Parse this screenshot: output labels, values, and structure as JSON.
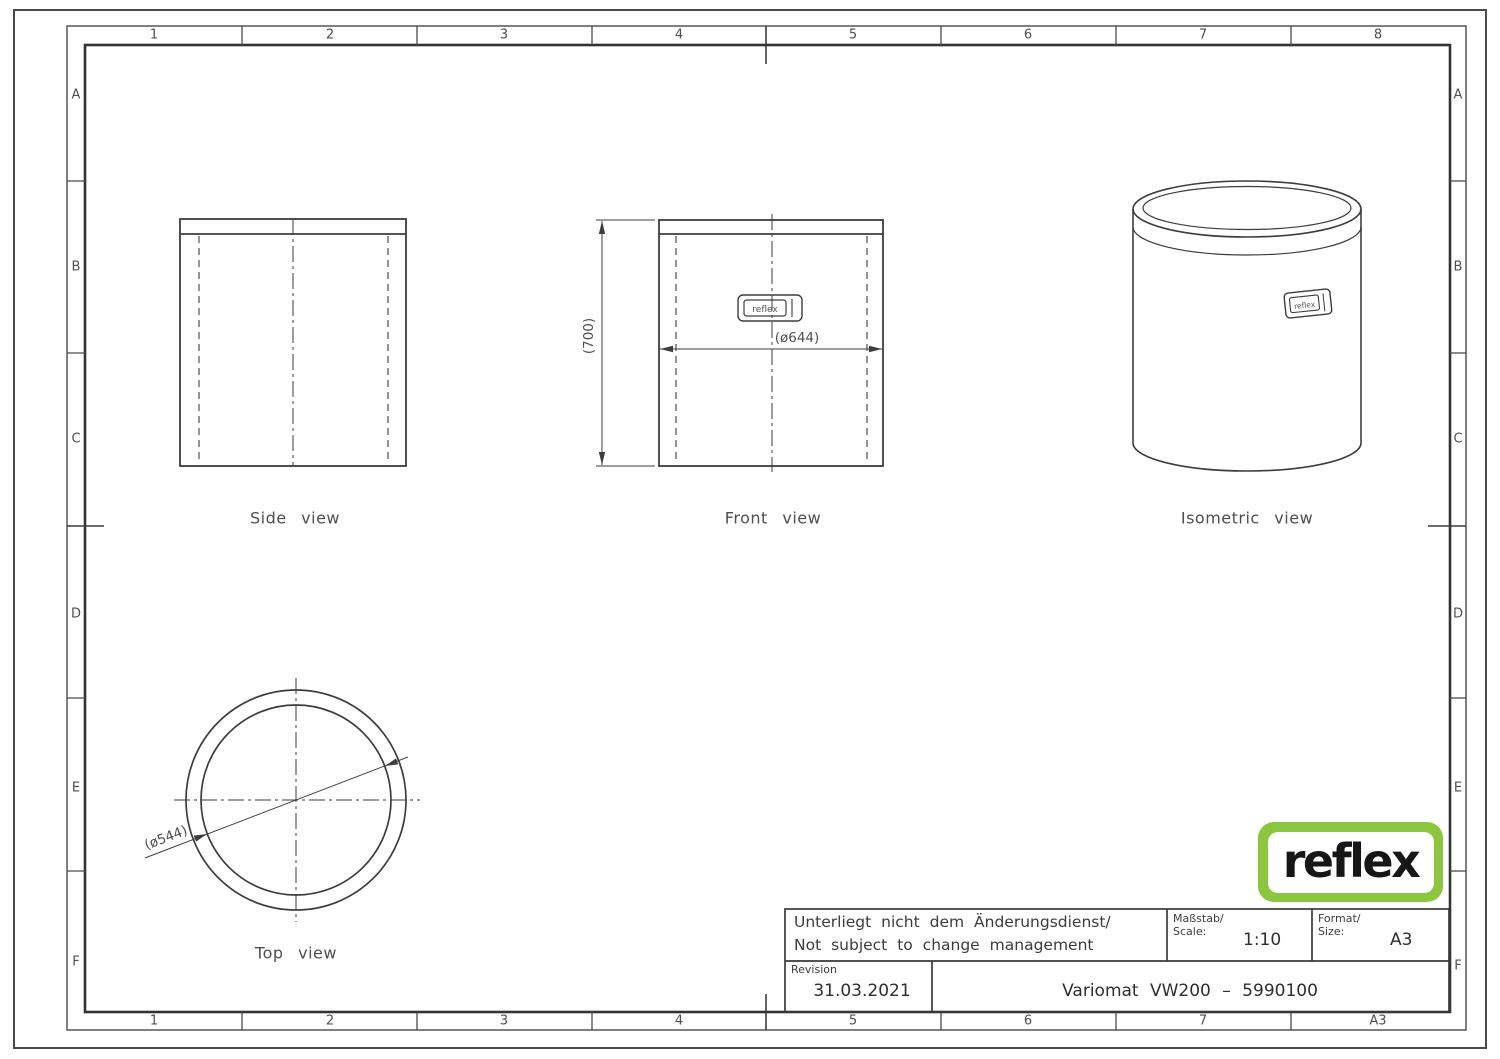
{
  "drawing": {
    "grid": {
      "cols_top": [
        "1",
        "2",
        "3",
        "4",
        "5",
        "6",
        "7",
        "8"
      ],
      "cols_bottom": [
        "1",
        "2",
        "3",
        "4",
        "5",
        "6",
        "7",
        "A3"
      ],
      "rows_left": [
        "A",
        "B",
        "C",
        "D",
        "E",
        "F"
      ],
      "rows_right": [
        "A",
        "B",
        "C",
        "D",
        "E",
        "F"
      ]
    },
    "views": {
      "side": {
        "label": "Side view"
      },
      "front": {
        "label": "Front view",
        "width_dim": "(ø644)",
        "height_dim": "(700)",
        "nameplate": "reflex"
      },
      "isometric": {
        "label": "Isometric view",
        "nameplate": "reflex"
      },
      "top": {
        "label": "Top view",
        "diameter_dim": "(ø544)"
      }
    },
    "title_block": {
      "note_line1": "Unterliegt nicht dem Änderungsdienst/",
      "note_line2": "Not subject to change management",
      "scale_label_de": "Maßstab/",
      "scale_label_en": "Scale:",
      "scale_value": "1:10",
      "format_label_de": "Format/",
      "format_label_en": "Size:",
      "format_value": "A3",
      "revision_label": "Revision",
      "revision_date": "31.03.2021",
      "part_number": "Variomat VW200 – 5990100"
    },
    "logo": {
      "text": "reflex"
    },
    "colors": {
      "logo_green": "#8CC63F",
      "line": "#3d3d3d"
    }
  }
}
